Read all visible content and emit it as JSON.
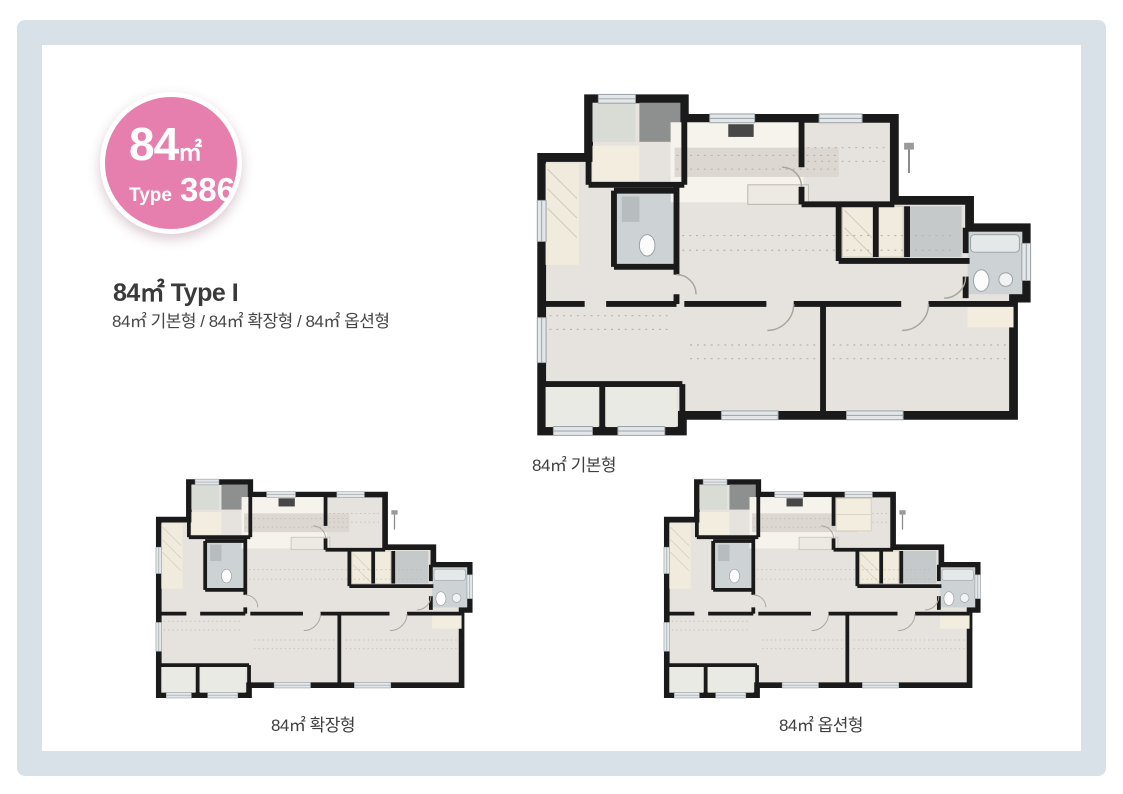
{
  "page": {
    "background": "#ffffff",
    "frame_color": "#d8e0e8",
    "card_color": "#ffffff"
  },
  "badge": {
    "area": "84",
    "unit": "㎡",
    "type_label": "Type",
    "type_number": "386",
    "color": "#e77fae"
  },
  "header": {
    "title": "84㎡ Type I",
    "subtitle": "84㎡ 기본형 / 84㎡ 확장형 / 84㎡ 옵션형"
  },
  "plans": [
    {
      "id": "basic",
      "caption": "84㎡ 기본형"
    },
    {
      "id": "expanded",
      "caption": "84㎡ 확장형"
    },
    {
      "id": "option",
      "caption": "84㎡ 옵션형"
    }
  ],
  "palette": {
    "wall": "#1a1a1a",
    "floor": "#e6e2dd",
    "tile": "#cdd2d5",
    "beige": "#f2edde",
    "counter": "#f6f3ec",
    "window": "#e3e7e9"
  }
}
